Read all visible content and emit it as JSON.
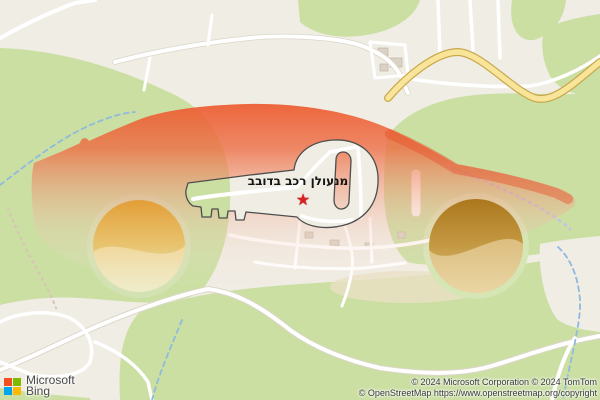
{
  "page": {
    "width": 600,
    "height": 400
  },
  "map": {
    "provider": "Bing Maps",
    "marker": {
      "label": "מנעולן רכב בדובב",
      "star_glyph": "★",
      "star_color": "#D92121"
    },
    "overlay": {
      "shape": "car-silhouette-with-key-cutout",
      "body_color_top": "#ED5A2E",
      "body_color_fade": "#F8DCD2",
      "left_wheel_color": "#E29B2F",
      "right_wheel_color": "#A87316",
      "key_outline_color": "#4D4D4D"
    },
    "colors": {
      "land": "#F0EDE4",
      "vegetation": "#CBDFA3",
      "road": "#FFFFFF",
      "highway_fill": "#F9E59A",
      "highway_casing": "#C9A94E",
      "stream": "#8FBADD",
      "trail": "#C9BCE8",
      "building": "#DAD2C6"
    },
    "logo": {
      "brand": "Microsoft",
      "product": "Bing"
    },
    "attribution": {
      "line1": "© 2024 Microsoft Corporation © 2024 TomTom",
      "line2": "© OpenStreetMap https://www.openstreetmap.org/copyright"
    }
  }
}
